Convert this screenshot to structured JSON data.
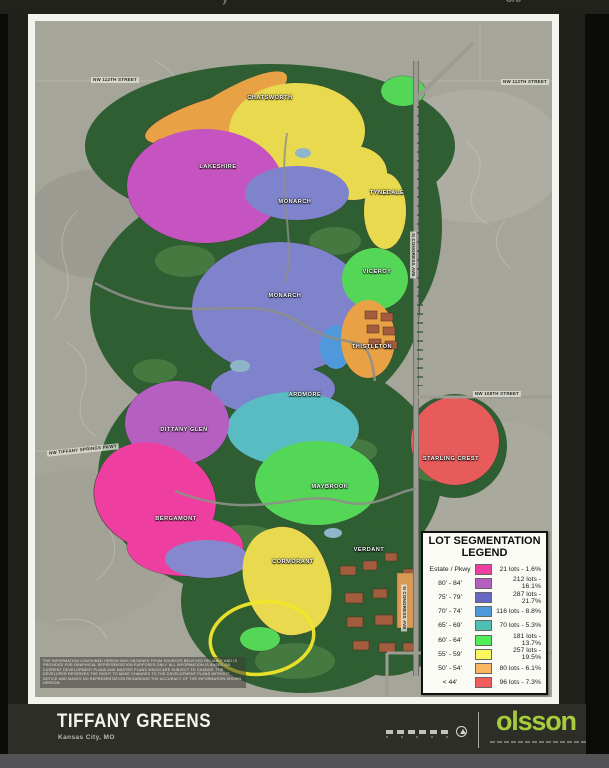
{
  "top_bar": {
    "fragments": [
      {
        "text": "y",
        "x": 222
      },
      {
        "text": "–",
        "x": 325
      },
      {
        "text": "–",
        "x": 424
      },
      {
        "text": "3/5",
        "x": 506
      }
    ]
  },
  "legend": {
    "title_line1": "LOT SEGMENTATION",
    "title_line2": "LEGEND",
    "rows": [
      {
        "label": "Estate / Pkwy",
        "color": "#ee3fa0",
        "text": "21 lots - 1.6%"
      },
      {
        "label": "80' - 84'",
        "color": "#b55fc0",
        "text": "212 lots - 16.1%"
      },
      {
        "label": "75' - 79'",
        "color": "#6568c2",
        "text": "287 lots - 21.7%"
      },
      {
        "label": "70' - 74'",
        "color": "#5098dc",
        "text": "116 lots - 8.8%"
      },
      {
        "label": "65' - 69'",
        "color": "#4fbfb3",
        "text": "70 lots - 5.3%"
      },
      {
        "label": "60' - 64'",
        "color": "#4fee58",
        "text": "181 lots - 13.7%"
      },
      {
        "label": "55' - 59'",
        "color": "#f9f75e",
        "text": "257 lots - 19.5%"
      },
      {
        "label": "50' - 54'",
        "color": "#f9b55f",
        "text": "80 lots - 6.1%"
      },
      {
        "label": "< 44'",
        "color": "#f25c5c",
        "text": "96 lots - 7.3%"
      }
    ]
  },
  "map": {
    "annotation_color": "#f2e62b",
    "neighborhoods": [
      {
        "name": "CHATSWORTH",
        "x": 235,
        "y": 77
      },
      {
        "name": "LAKESHIRE",
        "x": 183,
        "y": 146
      },
      {
        "name": "MONARCH",
        "x": 260,
        "y": 181
      },
      {
        "name": "TYNEDALE",
        "x": 352,
        "y": 172
      },
      {
        "name": "MONARCH",
        "x": 250,
        "y": 275
      },
      {
        "name": "VICEROY",
        "x": 342,
        "y": 251
      },
      {
        "name": "THISTLETON",
        "x": 337,
        "y": 326
      },
      {
        "name": "ARDMORE",
        "x": 270,
        "y": 374
      },
      {
        "name": "DITTANY GLEN",
        "x": 149,
        "y": 409
      },
      {
        "name": "STARLING CREST",
        "x": 416,
        "y": 438
      },
      {
        "name": "MAYBROOK",
        "x": 295,
        "y": 466
      },
      {
        "name": "BERGAMONT",
        "x": 141,
        "y": 498
      },
      {
        "name": "VERDANT",
        "x": 334,
        "y": 529
      },
      {
        "name": "CORMORANT",
        "x": 258,
        "y": 541
      }
    ],
    "street_labels": [
      {
        "name": "NW 112TH STREET",
        "x": 80,
        "y": 59,
        "rot": 0
      },
      {
        "name": "NW 112TH STREET",
        "x": 490,
        "y": 61,
        "rot": 0
      },
      {
        "name": "N CONGRESS AVE",
        "x": 378,
        "y": 234,
        "rot": 90
      },
      {
        "name": "NW 108TH STREET",
        "x": 462,
        "y": 373,
        "rot": 0
      },
      {
        "name": "NW TIFFANY SPRINGS PKWY",
        "x": 48,
        "y": 429,
        "rot": -6
      },
      {
        "name": "N CONGRESS AVE",
        "x": 369,
        "y": 587,
        "rot": 90
      },
      {
        "name": "NW OLD TIFFANY SPRINGS RD",
        "x": 433,
        "y": 626,
        "rot": 0
      }
    ],
    "disclaimer": "The information contained herein was obtained from sources believed reliable and is provided for graphical representation purposes only. All information is based on current development plans and master plans which are subject to change. The developer reserves the right to make changes to the development plans without notice and makes no representation regarding the accuracy of the information shown hereon."
  },
  "title_block": {
    "project_name": "TIFFANY GREENS",
    "project_location": "Kansas City, MO",
    "logo_text": "olsson",
    "logo_color": "#a7cc3b"
  }
}
